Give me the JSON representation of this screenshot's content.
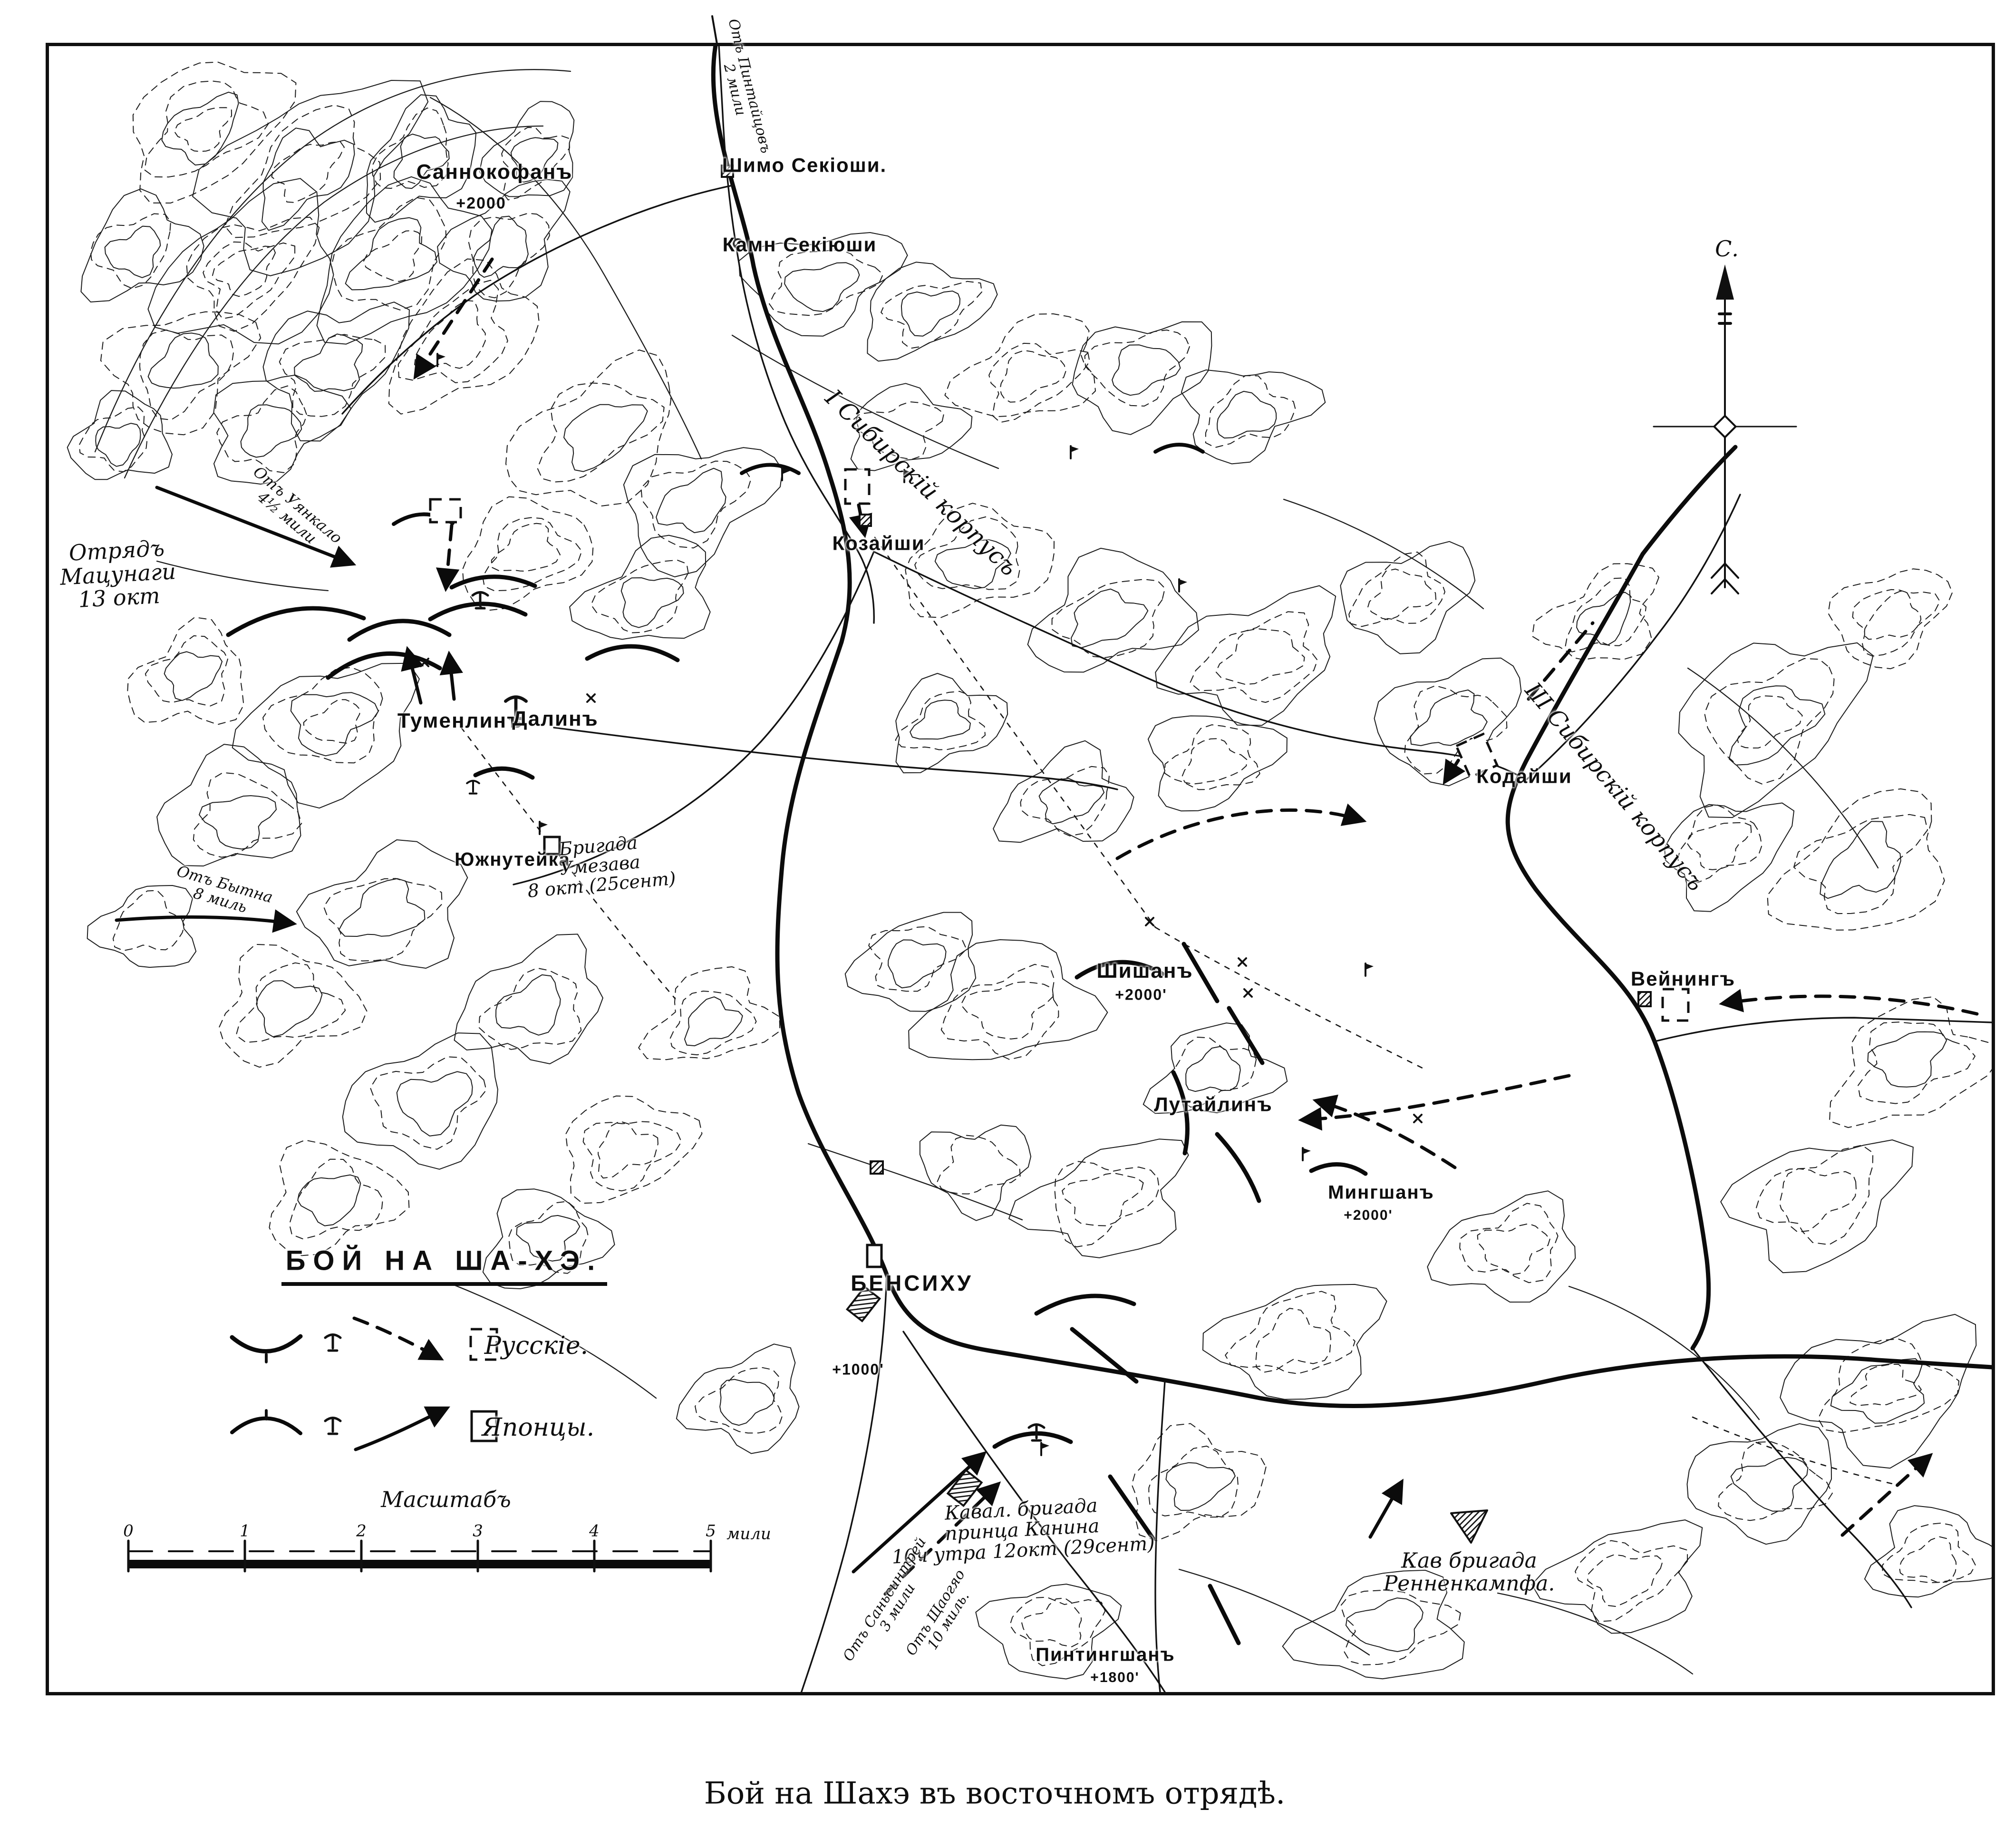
{
  "map": {
    "caption": "Бой на Шахэ въ восточномъ отрядѣ.",
    "compass": {
      "north_label": "С."
    },
    "colors": {
      "ink": "#111111",
      "paper": "#ffffff"
    },
    "icons": {
      "compass": "north-arrow",
      "russian_unit": "dashed-square",
      "japanese_unit": "solid-square",
      "village": "hatched-square",
      "battery": "artillery-mark",
      "flag": "flag-mark"
    },
    "legend": {
      "title": "БОЙ НА ША-ХЭ.",
      "russians_label": "Русскіе.",
      "japanese_label": "Японцы."
    },
    "scale": {
      "title": "Масштабъ",
      "ticks": [
        "0",
        "1",
        "2",
        "3",
        "4",
        "5"
      ],
      "unit": "мили"
    },
    "labels": {
      "sannokofan": "Саннокофанъ",
      "sannokofan_elev": "+2000",
      "shimo_sekiushi": "Шимо Секіоши.",
      "kamn_sekiushi": "Камн Секіюши",
      "road_pintaitsov_1": "Отъ Пинтайцовъ",
      "road_pintaitsov_2": "2 мили",
      "otryad_matsunagi_1": "Отрядъ",
      "otryad_matsunagi_2": "Мацунаги",
      "otryad_matsunagi_3": "13 окт",
      "road_uyankalo_1": "Отъ Уянкало",
      "road_uyankalo_2": "4½ мили",
      "i_sib_corpus": "I Сибирскій корпусъ",
      "kozaishi": "Козайши",
      "tumenlin": "Туменлинъ",
      "dalin": "Далинъ",
      "yuzhnuteika": "Южнутейка",
      "brigada_umezawa_1": "Бригада",
      "brigada_umezawa_2": "Умезава",
      "brigada_umezawa_3": "8 окт (25сент)",
      "road_bytna_1": "Отъ Бытна",
      "road_bytna_2": "8 миль",
      "shishan": "Шишанъ",
      "shishan_elev": "+2000'",
      "lutailin": "Лутайлинъ",
      "kodaishi": "Кодайши",
      "iii_sib_corpus": "III Сибирскій корпусъ",
      "veining": "Вейнингъ",
      "bensihu": "БЕНСИХУ",
      "bensihu_elev": "+1000'",
      "mingshan": "Мингшанъ",
      "mingshan_elev": "+2000'",
      "kaval_kanin_1": "Кавал. бригада",
      "kaval_kanin_2": "принца Канина",
      "kaval_kanin_3": "10ч утра 12окт (29сент)",
      "pintingshan": "Пинтингшанъ",
      "pintingshan_elev": "+1800'",
      "kav_rennenkampf_1": "Кав бригада",
      "kav_rennenkampf_2": "Ренненкампфа.",
      "road_sansintrey_1": "Отъ Саньсинтрей",
      "road_sansintrey_2": "3 мили",
      "road_schaogao_1": "Отъ Щаогяо",
      "road_schaogao_2": "10 миль."
    }
  }
}
